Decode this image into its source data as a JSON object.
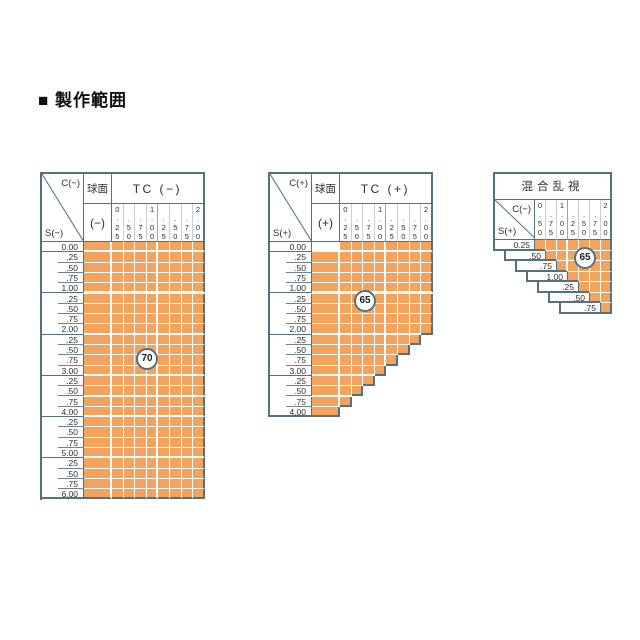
{
  "title": "■ 製作範囲",
  "colors": {
    "fill": "#F2A45F",
    "border": "#53717F",
    "grid_line": "#FFFFFF",
    "label_line": "#6D8593",
    "text": "#2E2E2E"
  },
  "tables": [
    {
      "kind": "grid",
      "name": "tc-minus-range-table",
      "corner": {
        "top": "C(−)",
        "bottom": "S(−)"
      },
      "sphere": {
        "header": "球面",
        "sub": "(−)"
      },
      "tc_header": "TC (−)",
      "columns": [
        "0.25",
        "0.50",
        "0.75",
        "1.00",
        "1.25",
        "1.50",
        "1.75",
        "2.00"
      ],
      "column_stacks": [
        [
          "0",
          ".",
          "2",
          "5"
        ],
        [
          "",
          ".",
          "5",
          "0"
        ],
        [
          "",
          ".",
          "7",
          "5"
        ],
        [
          "1",
          ".",
          "0",
          "0"
        ],
        [
          "",
          ".",
          "2",
          "5"
        ],
        [
          "",
          ".",
          "5",
          "0"
        ],
        [
          "",
          ".",
          "7",
          "5"
        ],
        [
          "2",
          ".",
          "0",
          "0"
        ]
      ],
      "rows": [
        "0.00",
        ".25",
        ".50",
        ".75",
        "1.00",
        ".25",
        ".50",
        ".75",
        "2.00",
        ".25",
        ".50",
        ".75",
        "3.00",
        ".25",
        ".50",
        ".75",
        "4.00",
        ".25",
        ".50",
        ".75",
        "5.00",
        ".25",
        ".50",
        ".75",
        "6.00"
      ],
      "sphere_filled": [
        true,
        true,
        true,
        true,
        true,
        true,
        true,
        true,
        true,
        true,
        true,
        true,
        true,
        true,
        true,
        true,
        true,
        true,
        true,
        true,
        true,
        true,
        true,
        true,
        true
      ],
      "tc_filled_per_row": [
        8,
        8,
        8,
        8,
        8,
        8,
        8,
        8,
        8,
        8,
        8,
        8,
        8,
        8,
        8,
        8,
        8,
        8,
        8,
        8,
        8,
        8,
        8,
        8,
        8
      ],
      "badge": {
        "value": "70"
      }
    },
    {
      "kind": "grid",
      "name": "tc-plus-range-table",
      "corner": {
        "top": "C(+)",
        "bottom": "S(+)"
      },
      "sphere": {
        "header": "球面",
        "sub": "(+)"
      },
      "tc_header": "TC (+)",
      "columns": [
        "0.25",
        "0.50",
        "0.75",
        "1.00",
        "1.25",
        "1.50",
        "1.75",
        "2.00"
      ],
      "column_stacks": [
        [
          "0",
          ".",
          "2",
          "5"
        ],
        [
          "",
          ".",
          "5",
          "0"
        ],
        [
          "",
          ".",
          "7",
          "5"
        ],
        [
          "1",
          ".",
          "0",
          "0"
        ],
        [
          "",
          ".",
          "2",
          "5"
        ],
        [
          "",
          ".",
          "5",
          "0"
        ],
        [
          "",
          ".",
          "7",
          "5"
        ],
        [
          "2",
          ".",
          "0",
          "0"
        ]
      ],
      "rows": [
        "0.00",
        ".25",
        ".50",
        ".75",
        "1.00",
        ".25",
        ".50",
        ".75",
        "2.00",
        ".25",
        ".50",
        ".75",
        "3.00",
        ".25",
        ".50",
        ".75",
        "4.00"
      ],
      "sphere_filled": [
        false,
        true,
        true,
        true,
        true,
        true,
        true,
        true,
        true,
        true,
        true,
        true,
        true,
        true,
        true,
        true,
        true
      ],
      "tc_filled_per_row": [
        8,
        8,
        8,
        8,
        8,
        8,
        8,
        8,
        8,
        7,
        6,
        5,
        4,
        3,
        2,
        1,
        0
      ],
      "badge": {
        "value": "65"
      }
    },
    {
      "kind": "stair",
      "name": "mixed-astigmatism-range-table",
      "title": "混合乱視",
      "corner": {
        "top": "C(−)",
        "bottom": "S(+)"
      },
      "columns": [
        "0.50",
        "0.75",
        "1.00",
        "1.25",
        "1.50",
        "1.75",
        "2.00"
      ],
      "column_stacks": [
        [
          "0",
          ".",
          "5",
          "0"
        ],
        [
          "",
          ".",
          "7",
          "5"
        ],
        [
          "1",
          ".",
          "0",
          "0"
        ],
        [
          "",
          ".",
          "2",
          "5"
        ],
        [
          "",
          ".",
          "5",
          "0"
        ],
        [
          "",
          ".",
          "7",
          "5"
        ],
        [
          "2",
          ".",
          "0",
          "0"
        ]
      ],
      "rows": [
        "0.25",
        ".50",
        ".75",
        "1.00",
        ".25",
        ".50",
        ".75"
      ],
      "badge": {
        "value": "65"
      }
    }
  ]
}
